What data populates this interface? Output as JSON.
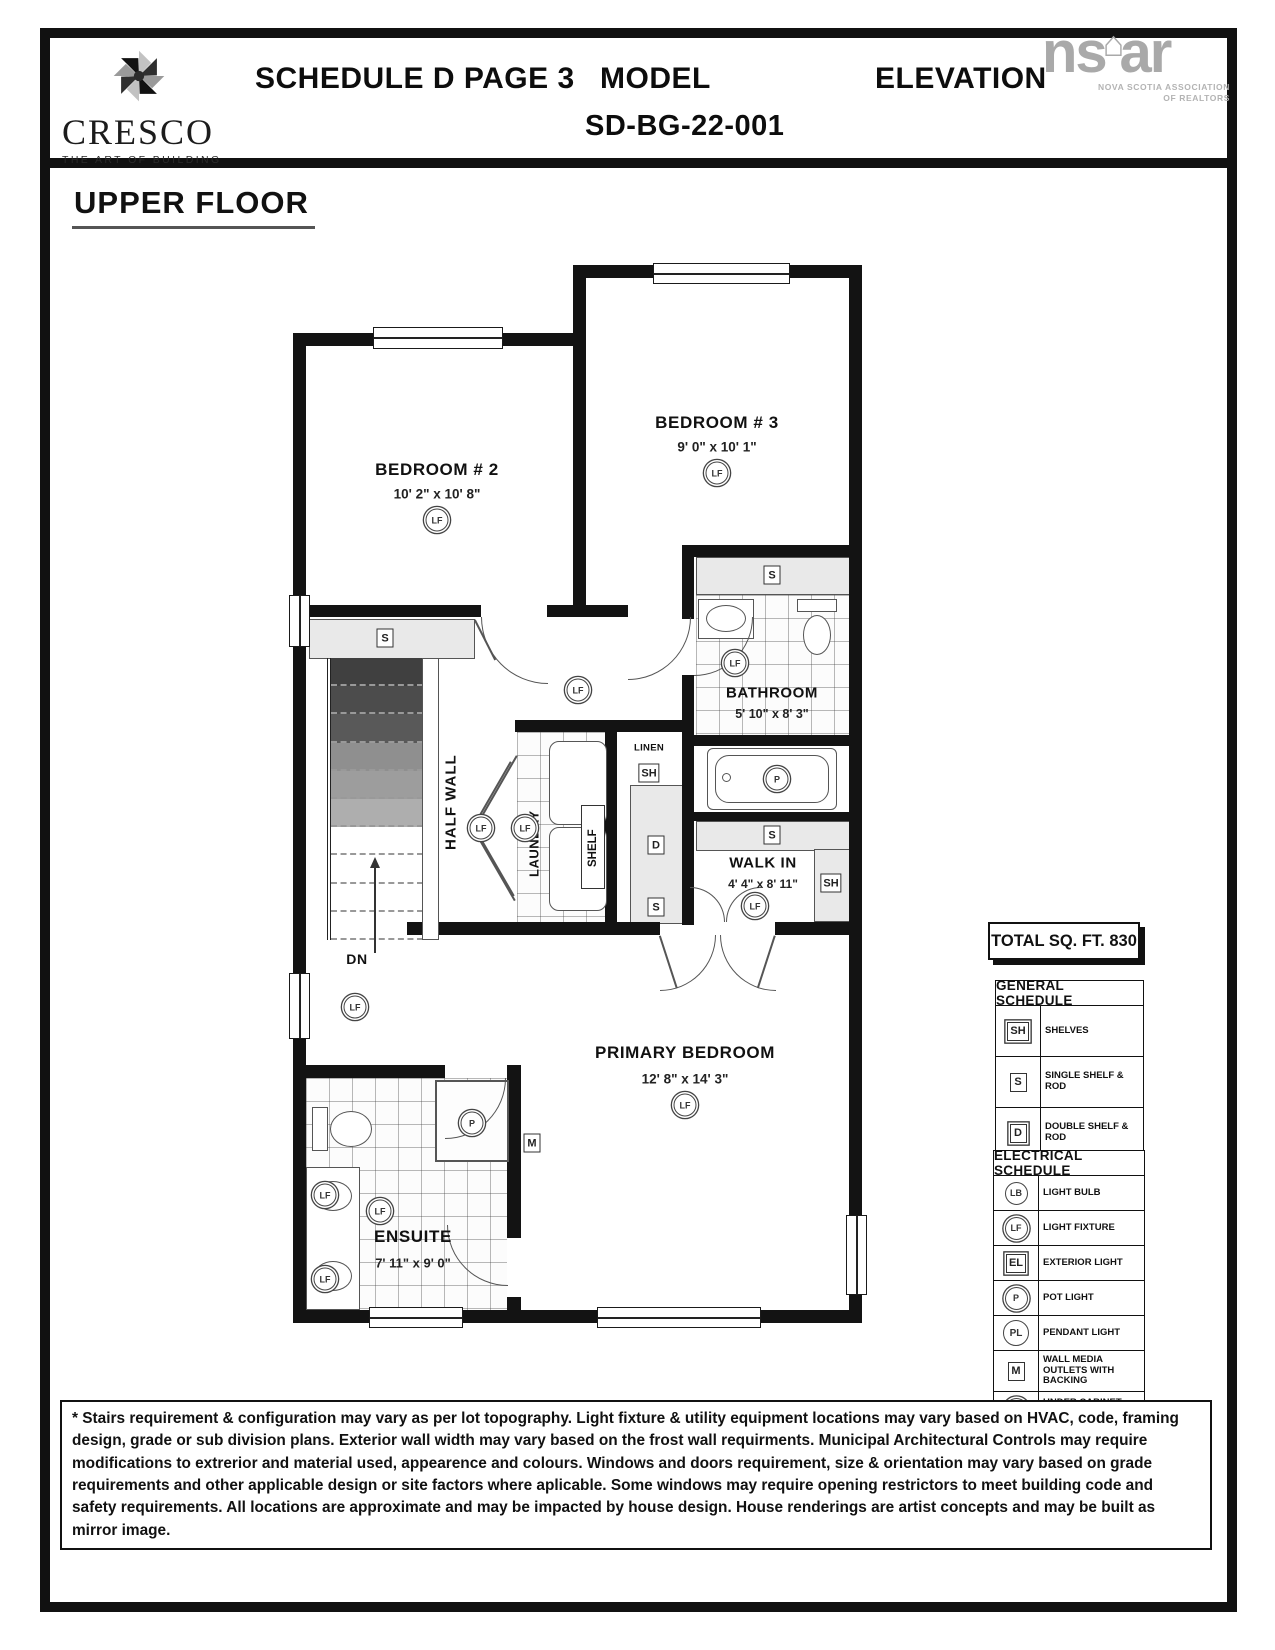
{
  "header": {
    "schedule": "SCHEDULE D PAGE 3",
    "model_label": "MODEL",
    "model_code": "SD-BG-22-001",
    "elevation_label": "ELEVATION"
  },
  "brand": {
    "name": "CRESCO",
    "tagline": "THE ART OF BUILDING"
  },
  "realtor_logo": {
    "mark_left": "ns",
    "house": "⌂",
    "mark_right": "ar",
    "line1": "NOVA SCOTIA ASSOCIATION",
    "line2": "OF REALTORS"
  },
  "page_title": "UPPER FLOOR",
  "rooms": {
    "bedroom2": {
      "name": "BEDROOM # 2",
      "dims": "10' 2\" x 10' 8\""
    },
    "bedroom3": {
      "name": "BEDROOM # 3",
      "dims": "9' 0\" x 10' 1\""
    },
    "bathroom": {
      "name": "BATHROOM",
      "dims": "5' 10\" x 8' 3\""
    },
    "walkin": {
      "name": "WALK IN",
      "dims": "4' 4\" x 8' 11\""
    },
    "primary": {
      "name": "PRIMARY BEDROOM",
      "dims": "12' 8\" x 14' 3\""
    },
    "ensuite": {
      "name": "ENSUITE",
      "dims": "7' 11\" x 9' 0\""
    }
  },
  "plan_labels": {
    "half_wall": "HALF WALL",
    "dn": "DN",
    "laundry": "LAUNDRY",
    "shelf": "SHELF",
    "linen": "LINEN"
  },
  "symbols": {
    "lf": "LF",
    "s": "S",
    "sh": "SH",
    "d": "D",
    "p": "P",
    "m": "M"
  },
  "total_area": {
    "label": "TOTAL SQ. FT. 830"
  },
  "general_schedule": {
    "title": "GENERAL SCHEDULE",
    "rows": [
      {
        "sym": "SH",
        "label": "SHELVES"
      },
      {
        "sym": "S",
        "label": "SINGLE SHELF & ROD"
      },
      {
        "sym": "D",
        "label": "DOUBLE SHELF & ROD"
      }
    ]
  },
  "electrical_schedule": {
    "title": "ELECTRICAL SCHEDULE",
    "rows": [
      {
        "sym": "LB",
        "label": "LIGHT BULB"
      },
      {
        "sym": "LF",
        "label": "LIGHT FIXTURE"
      },
      {
        "sym": "EL",
        "label": "EXTERIOR LIGHT"
      },
      {
        "sym": "P",
        "label": "POT LIGHT"
      },
      {
        "sym": "PL",
        "label": "PENDANT LIGHT"
      },
      {
        "sym": "M",
        "label": "WALL MEDIA OUTLETS WITH BACKING"
      },
      {
        "sym": "U",
        "label": "UNDER CABINET LIGHT"
      }
    ]
  },
  "footnote": "* Stairs requirement & configuration may vary as per lot topography. Light fixture & utility equipment locations may vary based on HVAC, code, framing design, grade or sub division plans. Exterior wall width may vary based on the frost wall requirments. Municipal Architectural Controls may require modifications to extrerior and material used, appearence and colours. Windows and doors requirement, size & orientation may vary based on grade requirements and other applicable design or site factors where aplicable. Some windows may require opening restrictors to meet building code and safety requirements. All locations are approximate and may be impacted by house design. House renderings are artist concepts and may be built as mirror image."
}
